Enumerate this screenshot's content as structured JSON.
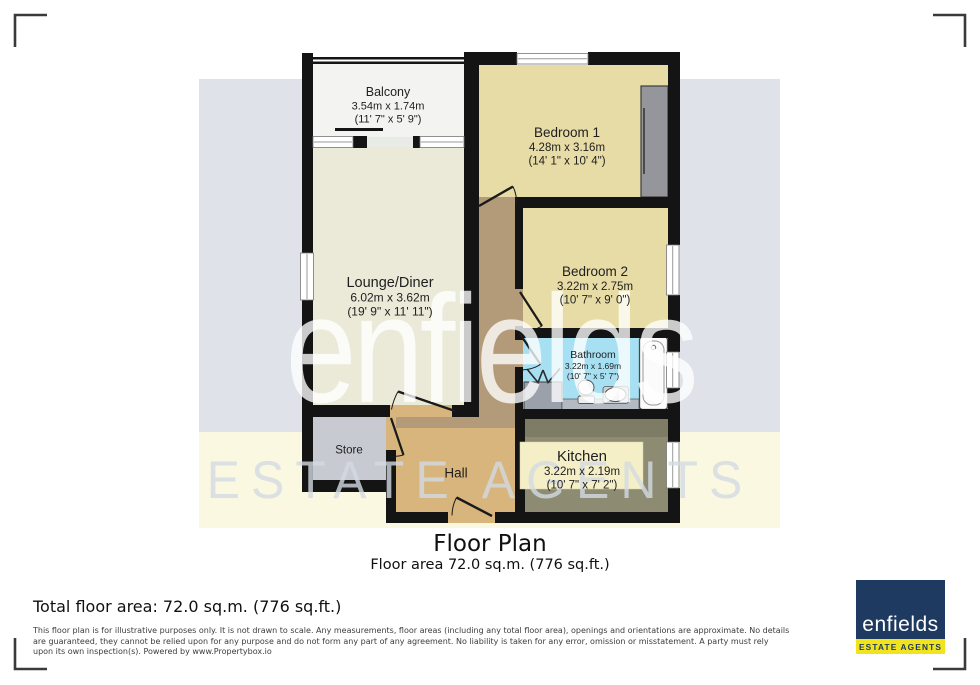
{
  "watermark": {
    "brand": "enfields",
    "tagline": "ESTATE AGENTS"
  },
  "plan": {
    "balcony": {
      "name": "Balcony",
      "metric": "3.54m x 1.74m",
      "imperial": "(11' 7\" x 5' 9\")"
    },
    "bedroom1": {
      "name": "Bedroom 1",
      "metric": "4.28m x 3.16m",
      "imperial": "(14' 1\" x 10' 4\")"
    },
    "lounge": {
      "name": "Lounge/Diner",
      "metric": "6.02m x 3.62m",
      "imperial": "(19' 9\" x 11' 11\")"
    },
    "bedroom2": {
      "name": "Bedroom 2",
      "metric": "3.22m x 2.75m",
      "imperial": "(10' 7\" x 9' 0\")"
    },
    "bathroom": {
      "name": "Bathroom",
      "metric": "3.22m x 1.69m",
      "imperial": "(10' 7\" x 5' 7\")"
    },
    "store": {
      "name": "Store"
    },
    "hall": {
      "name": "Hall"
    },
    "kitchen": {
      "name": "Kitchen",
      "metric": "3.22m x 2.19m",
      "imperial": "(10' 7\" x 7' 2\")"
    }
  },
  "caption": {
    "title": "Floor Plan",
    "subtitle": "Floor area 72.0 sq.m. (776 sq.ft.)"
  },
  "footer": {
    "total_area": "Total floor area: 72.0 sq.m. (776 sq.ft.)",
    "disclaimer": "This floor plan is for illustrative purposes only. It is not drawn to scale. Any measurements, floor areas (including any total floor area), openings and orientations are approximate. No details are guaranteed, they cannot be relied upon for any purpose and do not form any part of any agreement. No liability is taken for any error, omission or misstatement. A party must rely upon its own inspection(s). Powered by www.Propertybox.io"
  },
  "logo": {
    "brand": "enfields",
    "tagline": "ESTATE AGENTS"
  },
  "colors": {
    "brand_navy": "#1e3a60",
    "brand_yellow": "#f1e31d",
    "band_gray": "#dfe3e9",
    "band_yellow": "#fbf8e2",
    "bathroom_blue": "#a6e0f2",
    "bedroom_beige": "#e8dca6",
    "hall_tan": "#d7b57d",
    "kitchen_olive": "#8d8b72"
  }
}
